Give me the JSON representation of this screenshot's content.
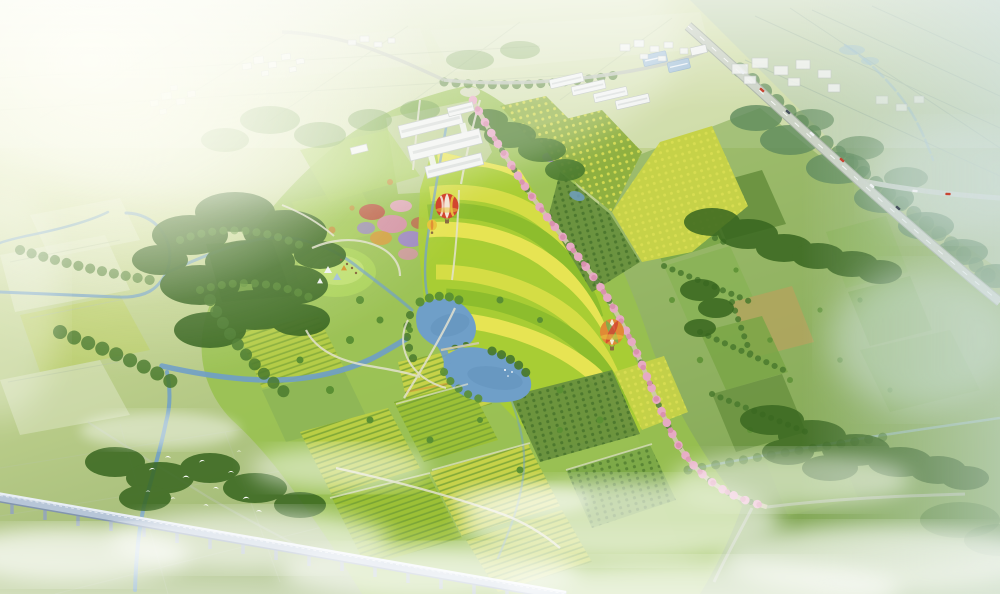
{
  "canvas": {
    "width": 1000,
    "height": 594
  },
  "scene": {
    "view": "oblique aerial perspective",
    "setting": "eco-agricultural park master plan rendering over rural plain",
    "landmarks": {
      "lake": "central blue lake with islets and footbridge",
      "terraced_fields": "curved contour bands of yellow and green crops",
      "blossom_avenue": "pink flowering-tree road crossing the park diagonally",
      "railway_viaduct": "elevated rail bridge crossing the lower-left on piers",
      "highway": "tree-lined highway crossing the upper-right with traffic",
      "courtyard_buildings": "white-roofed visitor courtyard complex",
      "greenhouses": "row of white greenhouses near the north entrance",
      "blue_warehouses": "blue-roofed farm sheds",
      "hot_air_balloons": "balloons floating over the flower terraces",
      "egret_flock": "white egrets above the misty meadow",
      "orchards": "gridded orchard and vineyard plots",
      "meadow_camp": "lawn clearing with small tents and grazing animals",
      "flower_gardens": "red, pink and purple flower beds",
      "streams": "meandering streams and river feeding the lake",
      "villages": "distant white village and factory buildings",
      "mist": "low clouds drifting across the fields",
      "sun_glow": "bright warm haze washing the upper-left corner"
    },
    "counts": {
      "hot_air_balloons": 3,
      "greenhouses": 4,
      "blue_warehouses": 2,
      "lake_islets": 2,
      "egrets": 12
    }
  },
  "palette": {
    "bg_top": "#edf1d2",
    "bg_mid": "#c6d694",
    "bg_bottom": "#8fac66",
    "glow": "#fdfdf0",
    "distant_field": "#e2e9cb",
    "distant_line": "#b7c6a2",
    "hazy_green": "#b9cdbb",
    "hazy_grid": "#9fb5a2",
    "park_base": "#98c14e",
    "lawn_dark": "#6f9e3c",
    "lawn_light": "#a8cd58",
    "meadow": "#abd35a",
    "meadow_light": "#c3e273",
    "terr1": "#e7e453",
    "terr2": "#a9cd33",
    "terr3": "#d5dd45",
    "terr4": "#8dbd2d",
    "orch_green": "#8fb040",
    "orch_yellow": "#c6d248",
    "orch_dot": "#dade52",
    "row_green": "#6f9c33",
    "row_dark": "#46722a",
    "field_lime": "#bace44",
    "field_green": "#9cc036",
    "farm_green": "#7aa647",
    "farm_dark": "#68903e",
    "farm_light": "#8ab257",
    "farm_tan": "#b2a55e",
    "forest_dark": "#38661f",
    "forest_mid": "#4a7a2e",
    "tree_green": "#5a8f33",
    "hazy_forest": "#5f8b5c",
    "autumn": "#c9923f",
    "water": "#6f9fc8",
    "water_deep": "#5b88b4",
    "water_light": "#9cc0d0",
    "road_light": "#e3e2cf",
    "road_gray": "#bfc7b7",
    "highway": "#ccd3c6",
    "highway_edge": "#a9b3a5",
    "path_tan": "#cfc9a8",
    "plaza": "#dadcc2",
    "blossom": "#e6aac3",
    "blossom_deep": "#d98fae",
    "purple": "#9d84cc",
    "red_flower": "#c05a4a",
    "orange_flower": "#d89a3a",
    "building": "#f1f3f1",
    "building_edge": "#b9c0bd",
    "roof_ridge": "#d7dbd9",
    "roof_blue": "#a8c4da",
    "roof_blue_edge": "#8fb0c8",
    "viaduct": "#b7c6d8",
    "viaduct_hi": "#e9eff6",
    "viaduct_dark": "#8295ae",
    "pier": "#93a5bc",
    "balloon_red": "#d2452f",
    "balloon_white": "#f4efe0",
    "balloon_yellow": "#e7c53e",
    "balloon_orange": "#e08a35",
    "balloon_green": "#7fae49",
    "basket": "#8a6b42",
    "bird": "#ffffff",
    "mist": "#ffffff",
    "mist_cool": "#d7e5e8",
    "car_red": "#c84432",
    "car_white": "#eef1f3",
    "car_dark": "#47525e"
  }
}
